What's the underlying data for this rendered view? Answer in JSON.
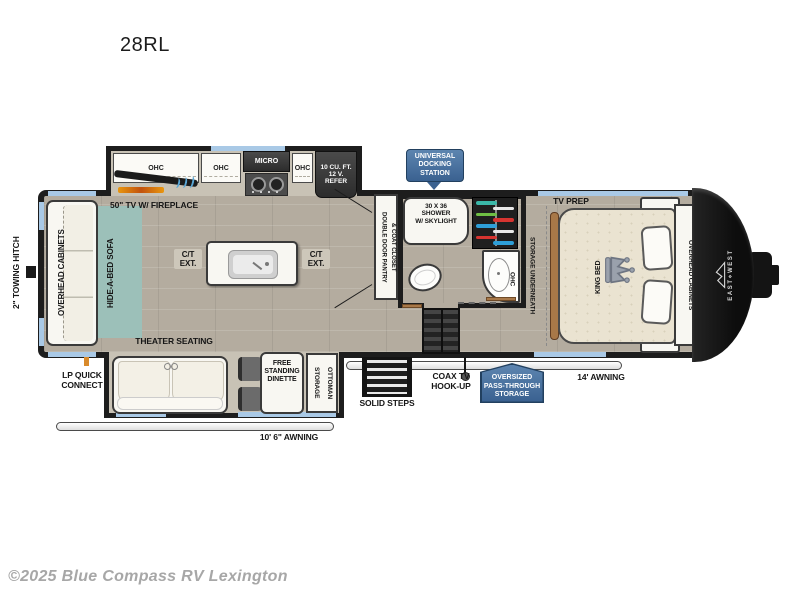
{
  "header": {
    "model": "28RL"
  },
  "footer": {
    "watermark": "©2025 Blue Compass RV Lexington"
  },
  "colors": {
    "wall": "#1d1d1d",
    "floor": "#b4ac9f",
    "slide_floor": "#c8c2b5",
    "window_blue": "#a9c9e6",
    "badge_top": "#5d85b0",
    "badge_bottom": "#3a6190",
    "badge_border": "#22405f",
    "rug_teal": "#9cc0b9",
    "accent_orange": "#d98a2b",
    "wood_trim": "#a87848",
    "hangers": [
      "#3bb8a9",
      "#e8e8e8",
      "#6fbf44",
      "#d63430",
      "#2e9fd8",
      "#e8e8e8",
      "#d63430",
      "#2e9fd8"
    ]
  },
  "kitchen": {
    "ohc1": "OHC",
    "ohc2": "OHC",
    "ohc3": "OHC",
    "micro": "MICRO",
    "refer": "10 CU. FT.\n12 V.\nREFER",
    "tv_fireplace": "50\" TV W/ FIREPLACE",
    "ct_ext_left": "C/T\nEXT.",
    "ct_ext_right": "C/T\nEXT.",
    "pantry": "DOUBLE DOOR PANTRY\n& COAT CLOSET"
  },
  "living": {
    "towing_hitch": "2\" TOWING HITCH",
    "overhead_cabinets": "OVERHEAD CABINETS",
    "sofa": "HIDE-A-BED SOFA",
    "theater": "THEATER SEATING",
    "dinette": "FREE\nSTANDING\nDINETTE",
    "ottoman": "STORAGE\nOTTOMAN"
  },
  "bath": {
    "shower": "30 X 36\nSHOWER\nW/ SKYLIGHT",
    "ohc": "OHC"
  },
  "bedroom": {
    "tv_prep": "TV PREP",
    "storage_underneath": "STORAGE UNDERNEATH",
    "king_bed": "KING BED",
    "overhead_cabinets": "OVERHEAD CABINETS",
    "brand": "EAST⋄WEST"
  },
  "exterior": {
    "docking_badge": "UNIVERSAL\nDOCKING\nSTATION",
    "passthrough_badge": "OVERSIZED\nPASS-THROUGH\nSTORAGE",
    "lp_quick": "LP QUICK\nCONNECT",
    "solid_steps": "SOLID STEPS",
    "coax": "COAX TV\nHOOK-UP",
    "awning_front": "14' AWNING",
    "awning_rear": "10' 6\" AWNING"
  }
}
